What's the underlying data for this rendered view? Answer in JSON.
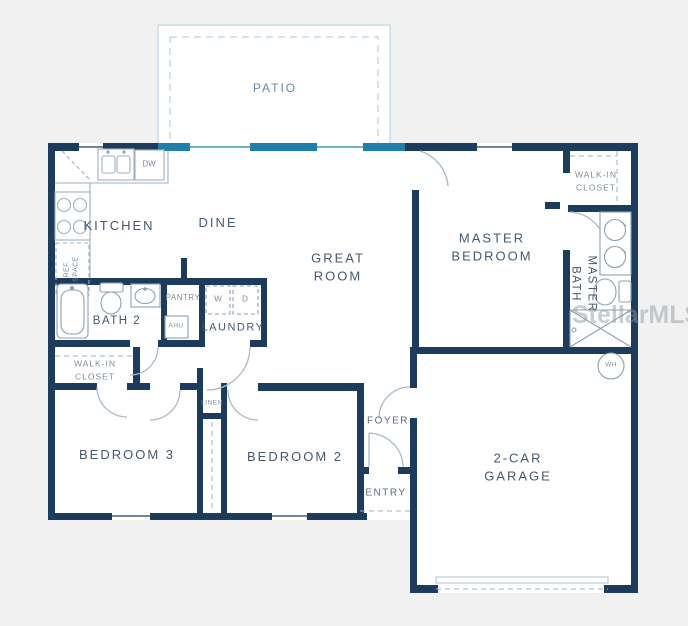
{
  "floorplan": {
    "title": "single-story house floor plan",
    "colors": {
      "background": "#f1f1f2",
      "floor": "#ffffff",
      "wall": "#1d3b5a",
      "accent_wall": "#1f7fa8",
      "patio_outline": "#b9d6e3",
      "fixture_line": "#8ba0b2",
      "room_label": "#46586d",
      "small_label": "#7e8c9b",
      "patio_label": "#5e8fa8"
    },
    "labels": {
      "patio": "PATIO",
      "kitchen": "KITCHEN",
      "dine": "DINE",
      "great_room": "GREAT\nROOM",
      "master_bedroom": "MASTER\nBEDROOM",
      "master_closet": "WALK-IN\nCLOSET",
      "master_bath": "MASTER\nBATH",
      "bath2": "BATH 2",
      "pantry": "PANTRY",
      "laundry": "LAUNDRY",
      "ahu": "AHU",
      "washer": "W",
      "dryer": "D",
      "dishwasher": "DW",
      "ref_space": "REF.\nSPACE",
      "closet2": "WALK-IN\nCLOSET",
      "bedroom3": "BEDROOM 3",
      "bedroom2": "BEDROOM 2",
      "linen": "LINEN",
      "foyer": "FOYER",
      "entry": "ENTRY",
      "garage": "2-CAR\nGARAGE",
      "water_heater": "WH",
      "watermark": "StellarMLS"
    }
  }
}
